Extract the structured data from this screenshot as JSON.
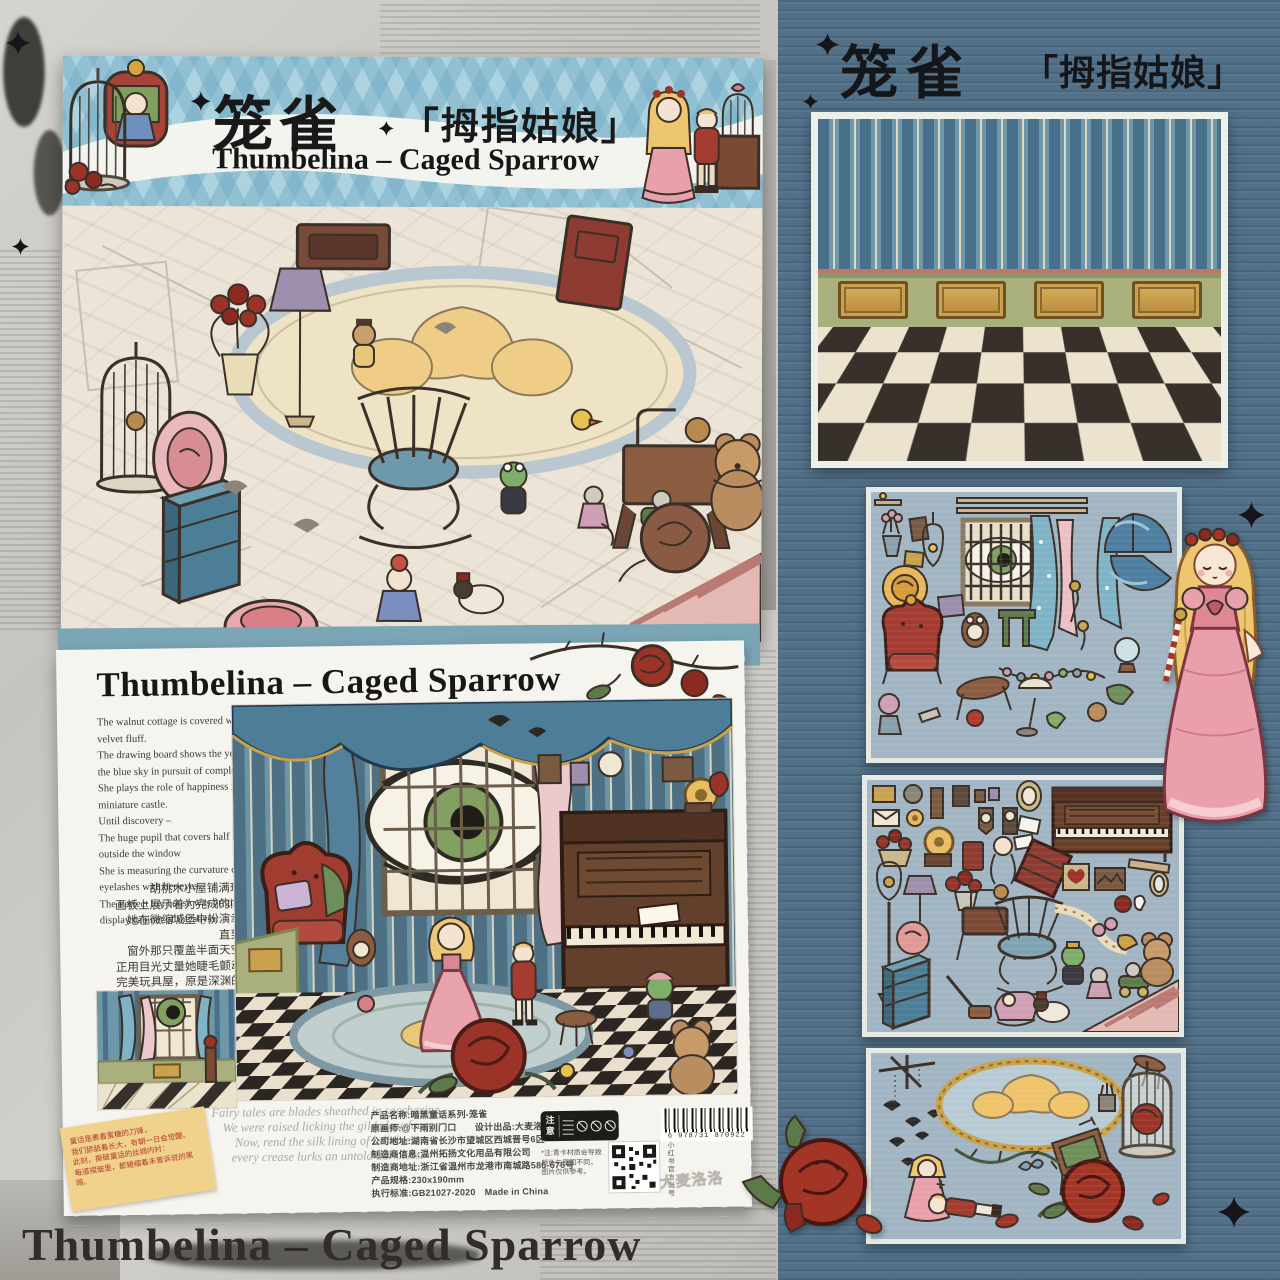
{
  "colors": {
    "background_blue": "#527189",
    "newsprint_gray": "#cbc9c4",
    "box_header_blue": "#aed3e0",
    "sheet_white": "#f6f4ee",
    "sticker_sheet_blue": "#a2b5c3",
    "accent_red": "#9c3328",
    "princess_pink": "#e79aa6",
    "note_yellow": "#f1d28c",
    "floor_dark": "#38302a"
  },
  "box": {
    "title_cn_main": "笼雀",
    "title_cn_sub": "「拇指姑娘」",
    "title_en": "Thumbelina – Caged Sparrow"
  },
  "right_column": {
    "title_cn_main": "笼雀",
    "title_cn_sub": "「拇指姑娘」"
  },
  "sheet": {
    "title_en": "Thumbelina – Caged Sparrow",
    "poem_en": [
      "The walnut cottage is covered with rose velvet fluff.",
      "The drawing board shows the yearning for the blue sky in pursuit of completion.",
      "She plays the role of happiness in the miniature castle.",
      "Until discovery –",
      "The huge pupil that covers half of the sky outside the window",
      "She is measuring the curvature of her eyelashes with her eyes.",
      "The Perfect toy house was originally a display cabinet of the abyss."
    ],
    "poem_cn": [
      "胡桃木小屋铺满玫瑰绒絮，",
      "画板上展示着为完成的向往蓝天。",
      "她在微缩城堡中扮演幸福角色，",
      "直到发现——",
      "窗外那只覆盖半面天空的巨瞳，",
      "正用目光丈量她睫毛颤动的弧度。",
      "完美玩具屋，原是深渊的展示柜。"
    ],
    "script_lines": [
      "Fairy tales are blades sheathed in saccharine,",
      "We were raised licking the gilded surface,",
      "Now, rend the silk lining of lullabies:",
      "every crease lurks an untold darkness."
    ],
    "note_lines": [
      "童话是裹着蜜糖的刀锋，",
      "我们舔舐着长大，有朝一日会觉醒。",
      "此刻，撕破童话的丝绸内衬：",
      "每道褶皱里，都蜷缩着未曾诉说的黑暗。"
    ],
    "product_info": [
      "产品名称:暗黑童话系列-笼雀",
      "原画师:@下雨别门口　　设计出品:大麦洛洛",
      "公司地址:湖南省长沙市望城区西城晋号6区",
      "制造商信息:温州拓扬文化用品有限公司",
      "制造商地址:浙江省温州市龙港市南城路586-676号",
      "产品规格:230x190mm",
      "执行标准:GB21027-2020　Made in China"
    ],
    "notice_badge": "注意",
    "qr_note": "*注:青卡材质会导致颜色与原图不同，图片仅供参考。",
    "qr_side_text": "小红书官方账号",
    "barcode_digits": "6 978731 870922",
    "logo_text": "大麦洛洛"
  },
  "page": {
    "bottom_caption": "Thumbelina – Caged Sparrow"
  }
}
